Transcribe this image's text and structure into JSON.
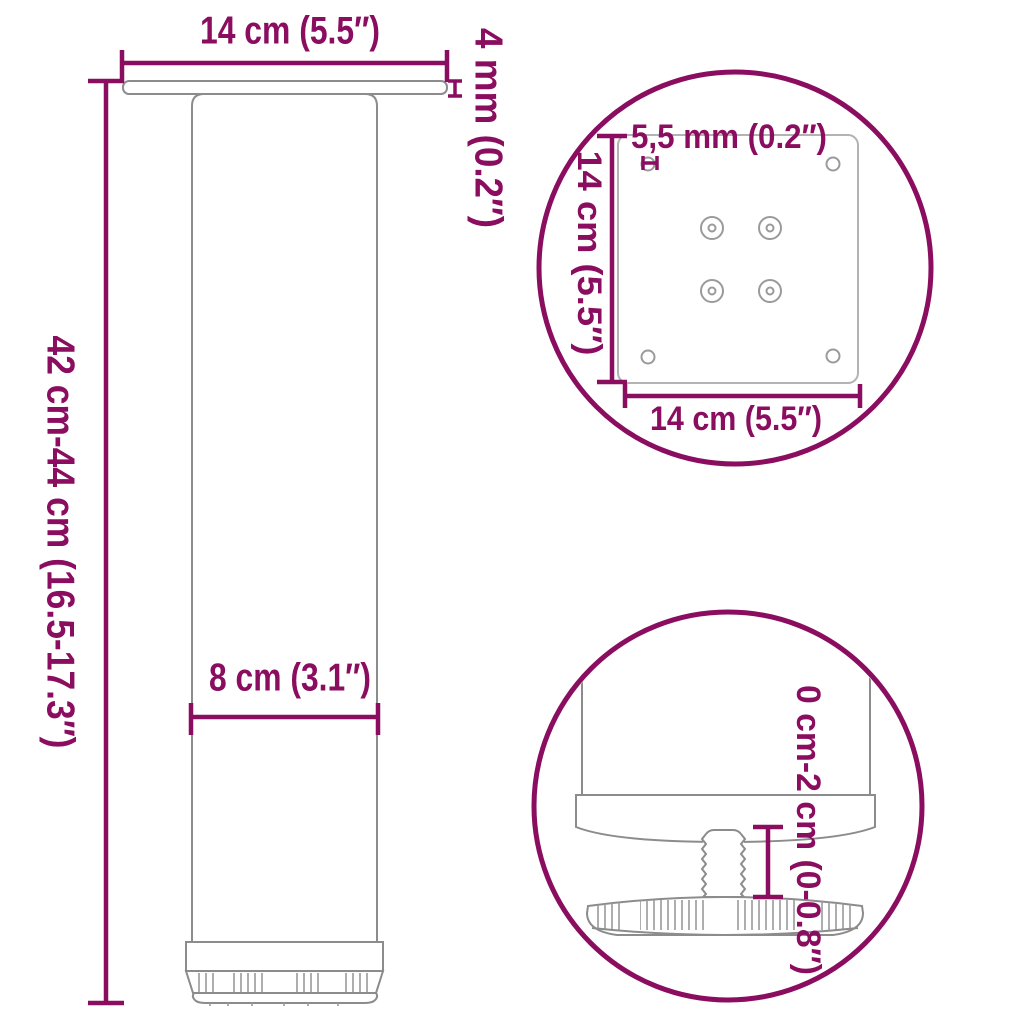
{
  "colors": {
    "accent": "#8A0D60",
    "outline": "#8C8C8C",
    "outline_light": "#B3B3B3",
    "detail_gray": "#9A9A9A"
  },
  "main_view": {
    "width_label": "14 cm (5.5″)",
    "thickness_label": "4 mm (0.2″)",
    "height_label": "42 cm-44 cm (16.5-17.3″)",
    "diameter_label": "8 cm (3.1″)"
  },
  "plate_detail": {
    "hole_label": "5,5 mm (0.2″)",
    "height_label": "14 cm (5.5″)",
    "width_label": "14 cm (5.5″)"
  },
  "foot_detail": {
    "range_label": "0 cm-2 cm (0-0.8″)"
  }
}
